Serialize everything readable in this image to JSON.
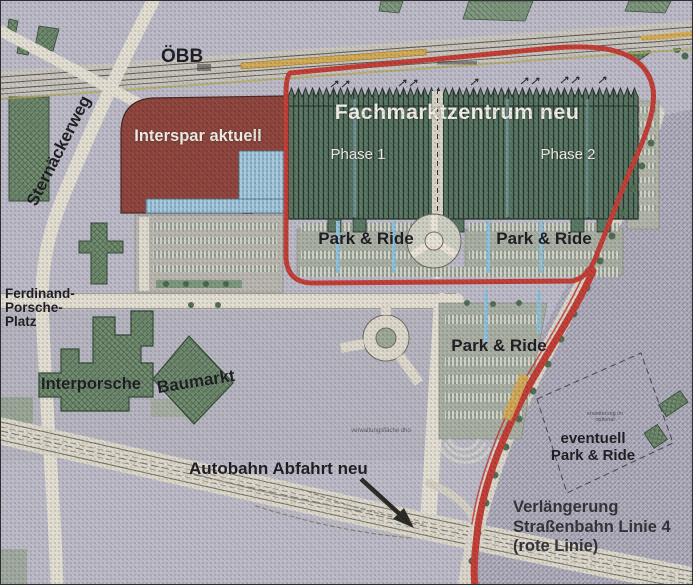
{
  "map_labels": {
    "oebb": "ÖBB",
    "sternaeckerweg": "Sternäckerweg",
    "interspar": "Interspar aktuell",
    "fachmarktzentrum": "Fachmarktzentrum neu",
    "phase1": "Phase 1",
    "phase2": "Phase 2",
    "park_ride_west": "Park & Ride",
    "park_ride_east": "Park & Ride",
    "park_ride_south": "Park & Ride",
    "ferdinand_porsche_platz": {
      "line1": "Ferdinand-",
      "line2": "Porsche-",
      "line3": "Platz"
    },
    "interporsche": "Interporsche",
    "baumarkt": "Baumarkt",
    "autobahn_abfahrt": "Autobahn Abfahrt neu",
    "eventuell": {
      "line1": "eventuell",
      "line2": "Park & Ride"
    },
    "verlaengerung": {
      "line1": "Verlängerung",
      "line2": "Straßenbahn Linie 4",
      "line3": "(rote Linie)"
    },
    "note_verwaltung": "verwaltungsfläche dho",
    "note_erweiterung": {
      "line1": "erweiterung im",
      "line2": "optional"
    }
  },
  "legend_colors": {
    "tram_line_red": "#c23a32",
    "interspar_building_red": "#8c4038",
    "fachmarktzentrum_green": "#4f6e60",
    "existing_building_green": "#6e8a6c",
    "canopy_blue": "#95c0d6",
    "road_cream": "#e4dfd1",
    "railway_platform_tan": "#d4a94f",
    "background_gray": "#bcbac6",
    "text_dark": "#17171c",
    "text_light": "#f3eee3"
  }
}
